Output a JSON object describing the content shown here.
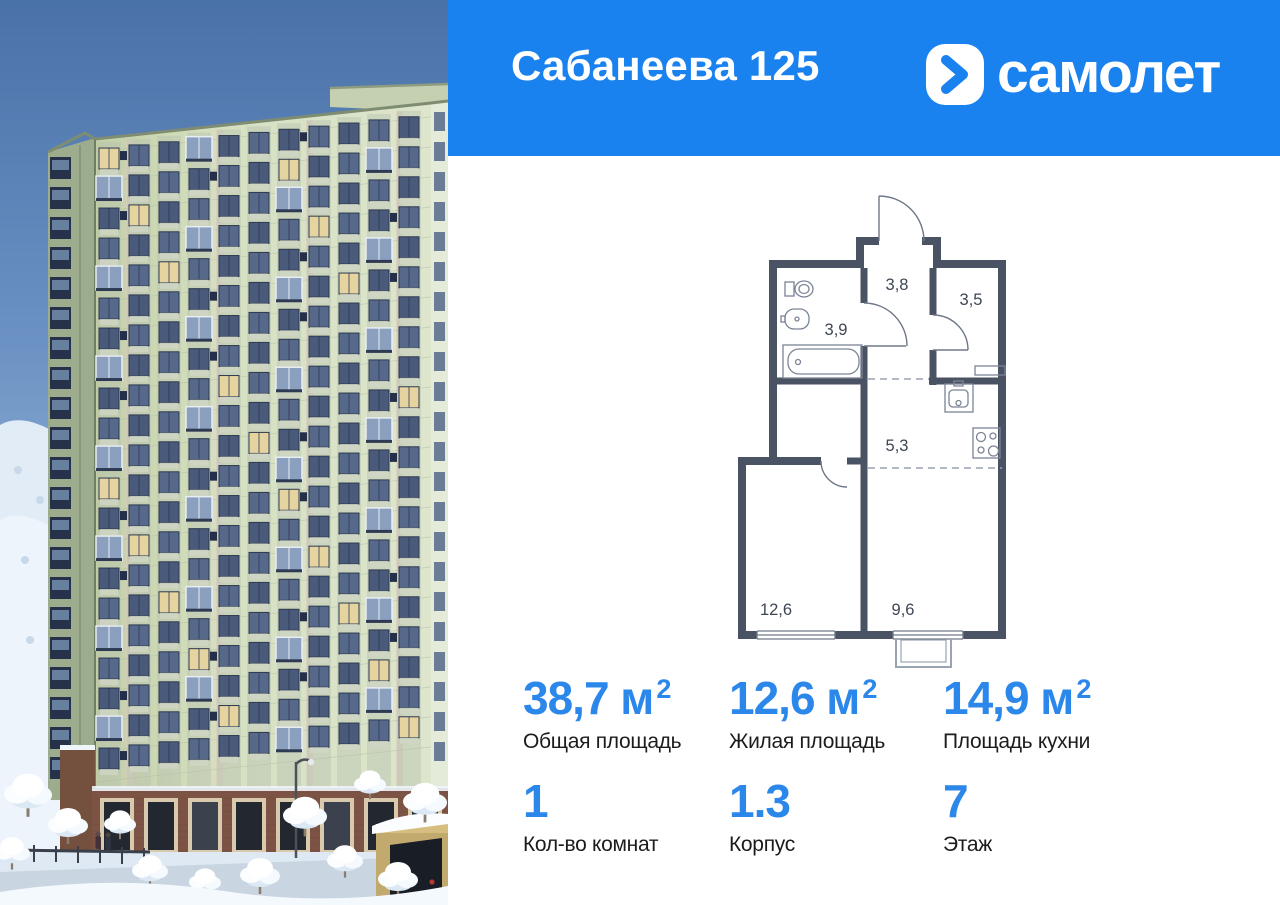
{
  "header": {
    "title": "Сабанеева 125",
    "brand_wordmark": "самолет"
  },
  "colors": {
    "header_bg": "#1a82ef",
    "accent_blue": "#2b87ea",
    "plan_wall": "#4a5363",
    "facade_green": "#cdd9ba"
  },
  "floor_plan": {
    "room_areas": {
      "hallway": "3,8",
      "wardrobe": "3,5",
      "bathroom": "3,9",
      "kitchen_zone": "5,3",
      "living_room": "12,6",
      "kitchen_dining": "9,6"
    }
  },
  "stats": {
    "row1": [
      {
        "num": "38,7",
        "unit": " м",
        "sup": "2",
        "label": "Общая площадь"
      },
      {
        "num": "12,6",
        "unit": " м",
        "sup": "2",
        "label": "Жилая площадь"
      },
      {
        "num": "14,9",
        "unit": " м",
        "sup": "2",
        "label": "Площадь кухни"
      }
    ],
    "row2": [
      {
        "num": "1",
        "label": "Кол-во комнат"
      },
      {
        "num": "1.3",
        "label": "Корпус"
      },
      {
        "num": "7",
        "label": "Этаж"
      }
    ]
  }
}
